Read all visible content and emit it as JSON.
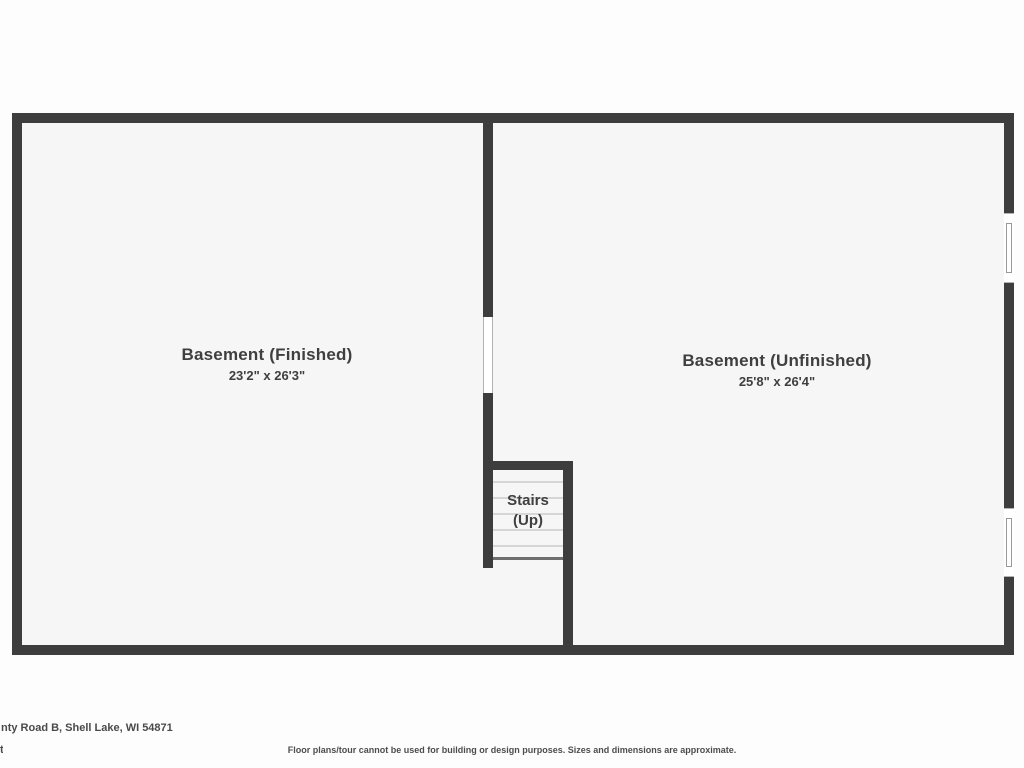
{
  "floor_plan": {
    "level": "Basement",
    "rooms": [
      {
        "name": "Basement (Finished)",
        "dimensions": "23'2\" x 26'3\""
      },
      {
        "name": "Basement (Unfinished)",
        "dimensions": "25'8\" x 26'4\""
      }
    ],
    "stairs": {
      "label_line1": "Stairs",
      "label_line2": "(Up)"
    },
    "features": [
      "door-opening-between-rooms",
      "window-right-wall-upper",
      "window-right-wall-lower"
    ],
    "colors": {
      "wall": "#3d3d3d",
      "floor": "#f6f6f6",
      "tread_line": "#d6d6d6",
      "stair_bottom_line": "#6f6f6f",
      "label_text": "#3f3f3f"
    }
  },
  "footer": {
    "address": "nty Road B, Shell Lake, WI 54871",
    "address_fragment": "t",
    "disclaimer": "Floor plans/tour cannot be used for building or design purposes. Sizes and dimensions are approximate."
  }
}
